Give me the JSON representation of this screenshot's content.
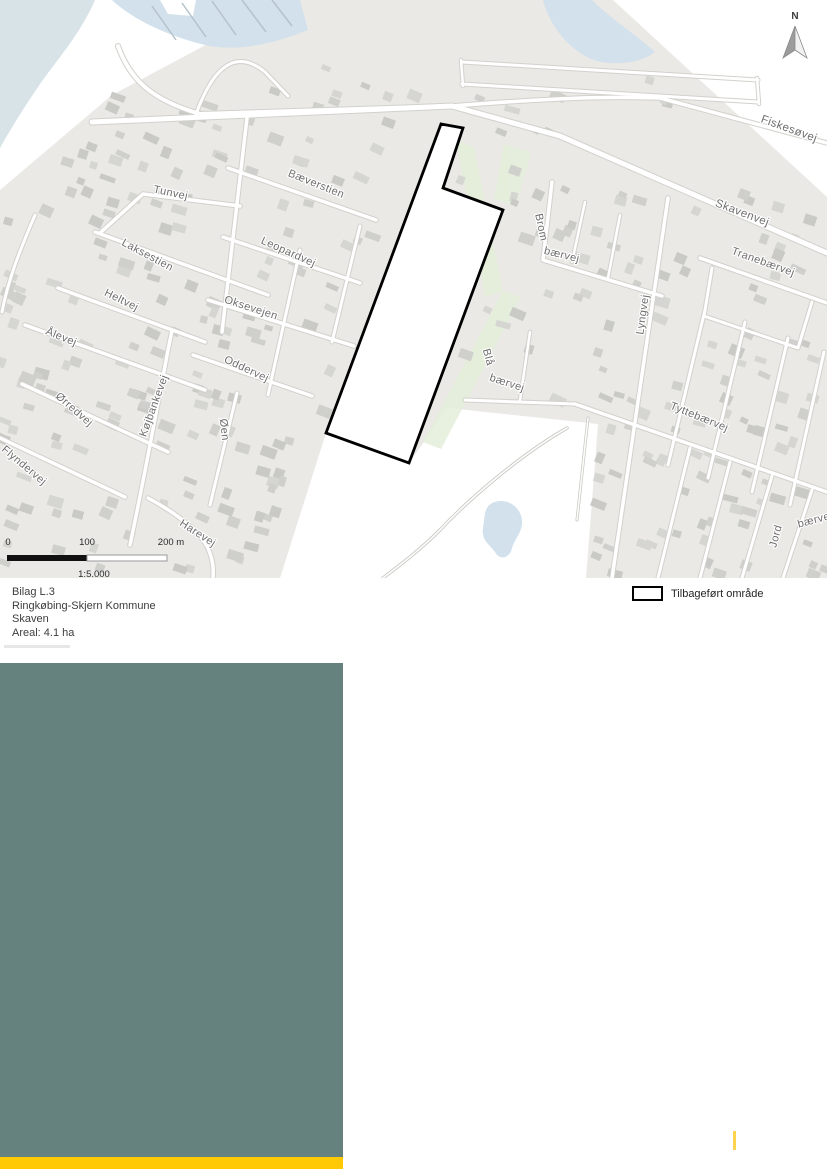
{
  "caption": {
    "lines": [
      "Bilag L.3",
      "Ringkøbing-Skjern Kommune",
      "Skaven",
      "Areal: 4.1 ha"
    ]
  },
  "legend": {
    "area_label": "Tilbageført område"
  },
  "north": {
    "label": "N"
  },
  "scalebar": {
    "tick_0": "0",
    "tick_100": "100",
    "tick_200": "200 m",
    "ratio": "1:5.000"
  },
  "streets": [
    {
      "text": "Tunvej",
      "x": 170,
      "y": 196,
      "rot": 12,
      "size": 11
    },
    {
      "text": "Bæverstien",
      "x": 315,
      "y": 187,
      "rot": 22,
      "size": 11
    },
    {
      "text": "Laksestien",
      "x": 146,
      "y": 258,
      "rot": 28,
      "size": 11
    },
    {
      "text": "Leopardvej",
      "x": 287,
      "y": 255,
      "rot": 24,
      "size": 11
    },
    {
      "text": "Heltvej",
      "x": 120,
      "y": 303,
      "rot": 26,
      "size": 11
    },
    {
      "text": "Oksevejen",
      "x": 250,
      "y": 311,
      "rot": 18,
      "size": 11
    },
    {
      "text": "Ålevej",
      "x": 60,
      "y": 340,
      "rot": 22,
      "size": 11
    },
    {
      "text": "Oddervej",
      "x": 245,
      "y": 372,
      "rot": 25,
      "size": 11
    },
    {
      "text": "Ørredvej",
      "x": 72,
      "y": 412,
      "rot": 41,
      "size": 11
    },
    {
      "text": "Flyndervej",
      "x": 22,
      "y": 468,
      "rot": 40,
      "size": 11
    },
    {
      "text": "Køjbankevej",
      "x": 157,
      "y": 407,
      "rot": -70,
      "size": 11
    },
    {
      "text": "Øen",
      "x": 221,
      "y": 430,
      "rot": 84,
      "size": 11
    },
    {
      "text": "Harevej",
      "x": 196,
      "y": 536,
      "rot": 33,
      "size": 11
    },
    {
      "text": "Fiskesøvej",
      "x": 788,
      "y": 132,
      "rot": 20,
      "size": 11.5
    },
    {
      "text": "Skavenvej",
      "x": 741,
      "y": 216,
      "rot": 21,
      "size": 11.5
    },
    {
      "text": "Brom",
      "x": 538,
      "y": 228,
      "rot": 78,
      "size": 11
    },
    {
      "text": "bærvej",
      "x": 561,
      "y": 258,
      "rot": 14,
      "size": 11
    },
    {
      "text": "Tranebærvej",
      "x": 762,
      "y": 265,
      "rot": 20,
      "size": 11
    },
    {
      "text": "Lyngvej",
      "x": 646,
      "y": 315,
      "rot": -82,
      "size": 11
    },
    {
      "text": "Blå",
      "x": 485,
      "y": 358,
      "rot": 75,
      "size": 11
    },
    {
      "text": "bærvej",
      "x": 506,
      "y": 386,
      "rot": 18,
      "size": 11
    },
    {
      "text": "Tyttebærvej",
      "x": 698,
      "y": 420,
      "rot": 22,
      "size": 11
    },
    {
      "text": "Jord",
      "x": 779,
      "y": 537,
      "rot": -75,
      "size": 11
    },
    {
      "text": "bærvej",
      "x": 816,
      "y": 523,
      "rot": -15,
      "size": 11
    }
  ],
  "colors": {
    "land": "#eae9e5",
    "sea": "#d8e3e8",
    "water": "#d2e1ec",
    "green": "#e4efda",
    "teal_panel": "#66827e",
    "yellow_bar": "#ffca05",
    "yellow_tick": "#fcd450",
    "plan_outline": "#000000"
  }
}
